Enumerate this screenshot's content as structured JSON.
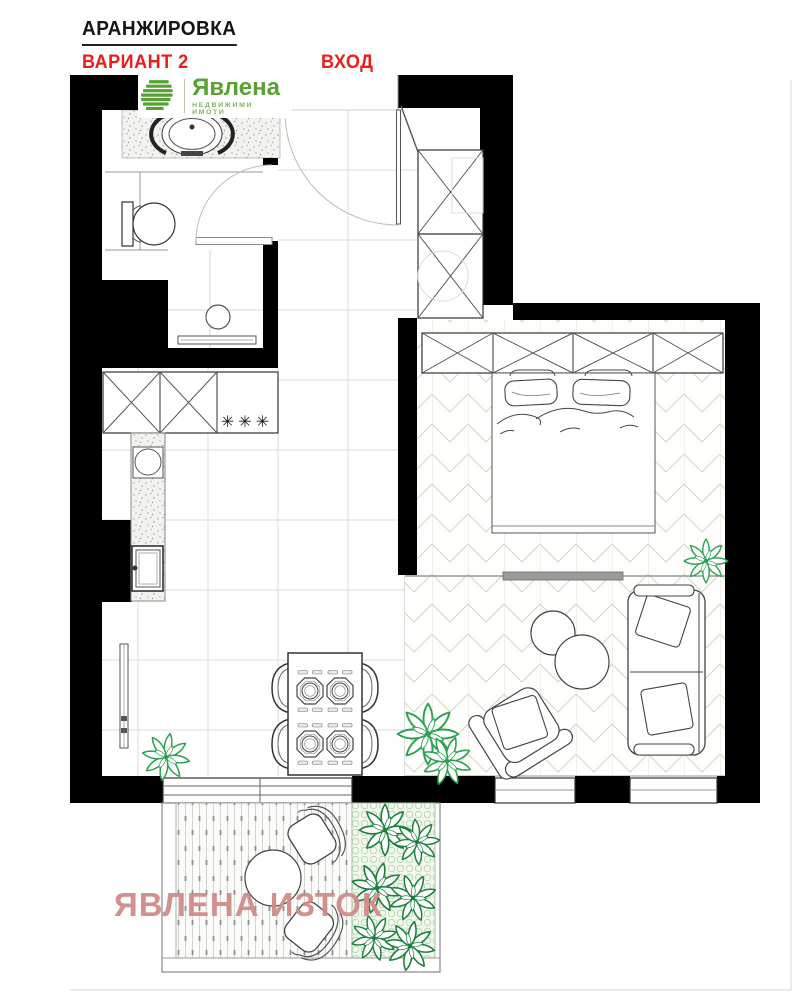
{
  "header": {
    "title": "АРАНЖИРОВКА",
    "variant": "ВАРИАНТ 2",
    "entrance_label": "ВХОД"
  },
  "logo": {
    "name": "Явлена",
    "tagline": "НЕДВИЖИМИ ИМОТИ",
    "icon": "yavlena-stripes-icon",
    "brand_color": "#57a233"
  },
  "watermark": {
    "text": "ЯВЛЕНА ИЗТОК",
    "color": "#d08c88"
  },
  "plan": {
    "hob_symbol": "✳✳✳"
  },
  "colors": {
    "wall": "#000000",
    "accent_red": "#ed1c1c",
    "furniture_line": "#444444",
    "tile_line": "#dcdcd8",
    "herringbone": "#d9d2c6",
    "plant_green": "#2aa050",
    "garden_plant_green": "#1c7f3e",
    "garden_lattice": "#b7d5ad",
    "watermark_pink": "#d08c88"
  }
}
